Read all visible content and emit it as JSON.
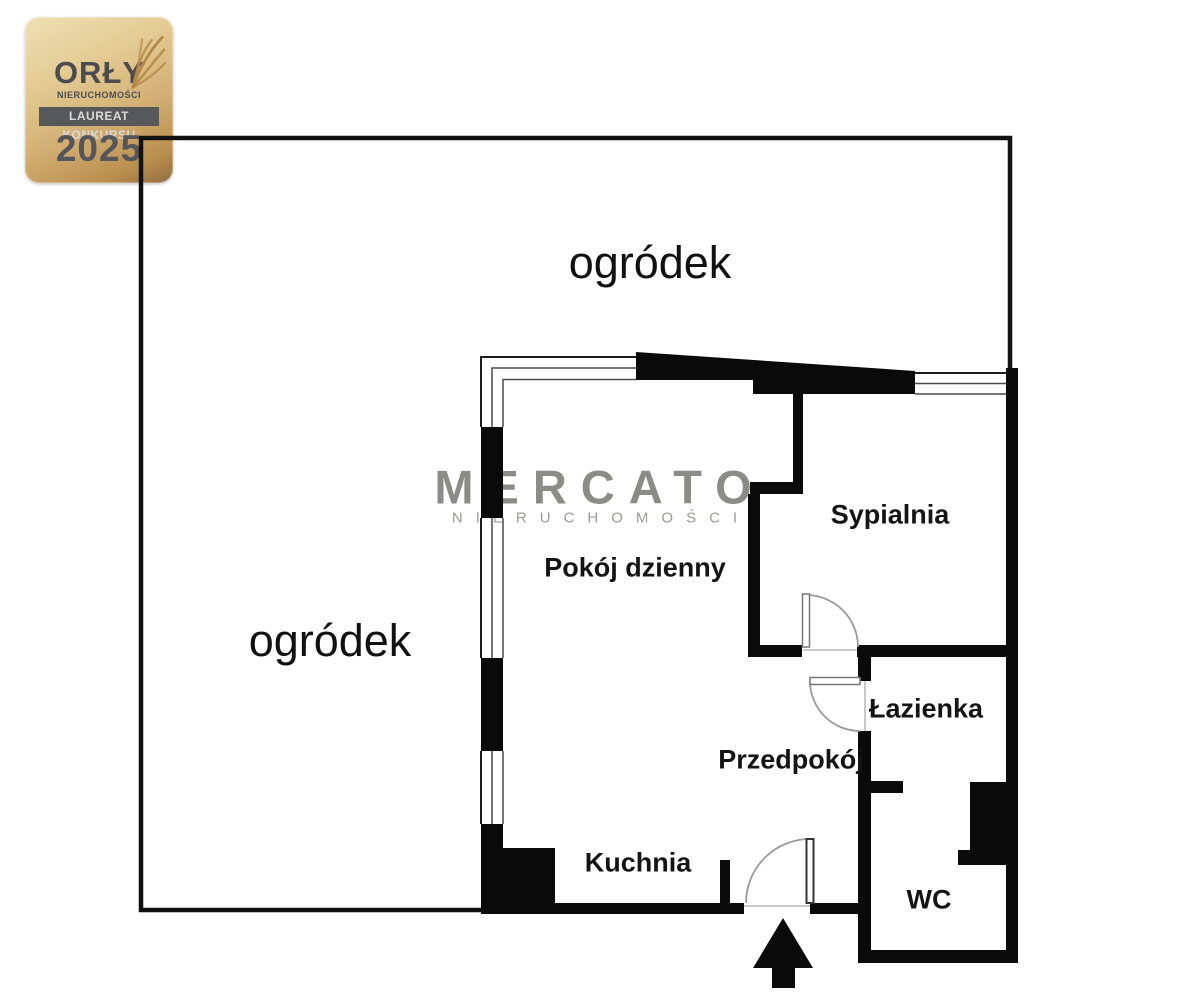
{
  "award_badge": {
    "title": "ORŁY",
    "subtitle": "NIERUCHOMOŚCI",
    "banner": "LAUREAT KONKURSU",
    "year": "2025"
  },
  "watermark": {
    "brand": "MERCATO",
    "tagline": "NIERUCHOMOŚCI"
  },
  "floor_plan": {
    "garden_label_top": "ogródek",
    "garden_label_left": "ogródek",
    "rooms": {
      "living_room": "Pokój dzienny",
      "bedroom": "Sypialnia",
      "bathroom": "Łazienka",
      "hallway": "Przedpokój",
      "kitchen": "Kuchnia",
      "wc": "WC"
    }
  },
  "colors": {
    "wall": "#0a0a0a",
    "boundary": "#111111",
    "door-arc": "#9a9a9a",
    "watermark": "#8b8b87",
    "label": "#141414",
    "badge-text": "#4c4c4e",
    "badge-banner-bg": "#57585a",
    "badge-banner-text": "#dbdad8",
    "badge-gold-light": "#eee0b5",
    "badge-gold-dark": "#906d3e"
  }
}
